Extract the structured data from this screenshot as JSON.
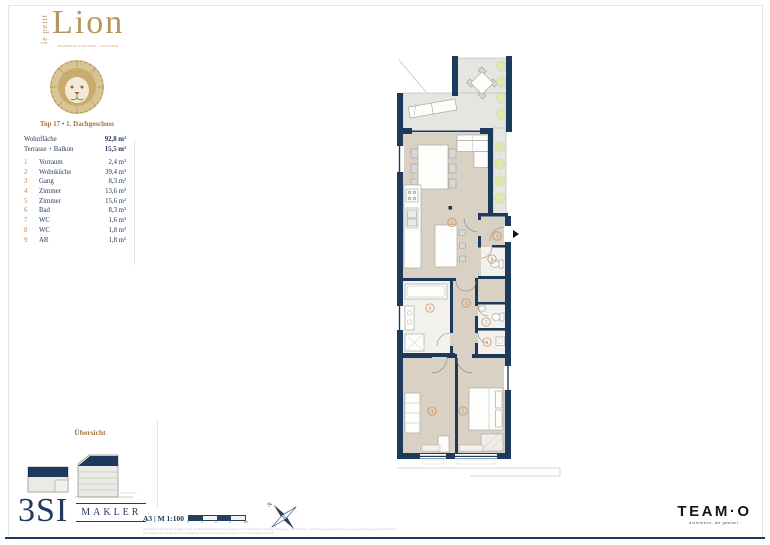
{
  "colors": {
    "navy": "#1c3a5c",
    "gold": "#b5965a",
    "rust": "#a9713c",
    "number_orange": "#c9824e",
    "floor_beige": "#d9d1c4",
    "terrace_grey": "#e5e5e2",
    "plant_green": "#dfe8ac"
  },
  "logo": {
    "prefix": "le petit",
    "name": "Lion",
    "tagline": "IM HERZEN VON WIEN | 1010 WIEN"
  },
  "unit": {
    "title": "Top 17 • 1. Dachgeschoss"
  },
  "summary": [
    {
      "label": "Wohnfläche",
      "value": "92,8 m²"
    },
    {
      "label": "Terrasse + Balkon",
      "value": "15,5 m²"
    }
  ],
  "rooms": [
    {
      "nr": "1",
      "name": "Vorraum",
      "area": "2,4 m²"
    },
    {
      "nr": "2",
      "name": "Wohnküche",
      "area": "39,4 m²"
    },
    {
      "nr": "3",
      "name": "Gang",
      "area": "8,3 m²"
    },
    {
      "nr": "4",
      "name": "Zimmer",
      "area": "13,6 m²"
    },
    {
      "nr": "5",
      "name": "Zimmer",
      "area": "15,6 m²"
    },
    {
      "nr": "6",
      "name": "Bad",
      "area": "8,3 m²"
    },
    {
      "nr": "7",
      "name": "WC",
      "area": "1,6 m²"
    },
    {
      "nr": "8",
      "name": "WC",
      "area": "1,8 m²"
    },
    {
      "nr": "9",
      "name": "AR",
      "area": "1,8 m²"
    }
  ],
  "overview": {
    "label": "Übersicht"
  },
  "broker": {
    "name": "3SI",
    "label": "MAKLER"
  },
  "sheet": {
    "info": "A3 | M 1:100",
    "scale_ticks": [
      "0",
      "1",
      "2",
      "3",
      "4m"
    ],
    "north": "N",
    "disclaimer_line1": "Alle Pläne und Flächenangaben sind Vorabinformationen und verstehen sich vorbehaltlich etwaiger Planungs-, Ausführungs- und Vermessungsänderungen sowie geringfügiger Abweichungen.",
    "disclaimer_line2": "Die dargestellte Möblierung dient lediglich der Veranschaulichung und ist nicht Vertragsbestandteil."
  },
  "architect": {
    "name": "TEAM·O",
    "tagline": "Architektur, die gewinnt."
  }
}
